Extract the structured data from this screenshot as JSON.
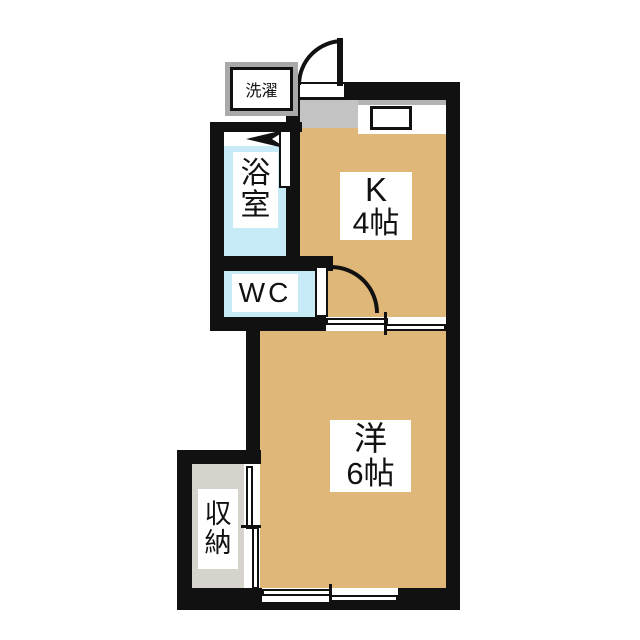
{
  "floorplan": {
    "background": "#ffffff",
    "colors": {
      "wall": "#111111",
      "floor_tan": "#dfb778",
      "wet_cyan": "#c6eaf6",
      "genkan_gray": "#c3c3c3",
      "storage_gray": "#d6d3cc",
      "washer_frame_gray": "#a9a9a9",
      "counter_edge_gray": "#b3b3b3",
      "label_bg": "#ffffff"
    },
    "rooms": {
      "washer": {
        "label": "洗濯"
      },
      "bath": {
        "label_line1": "浴",
        "label_line2": "室"
      },
      "wc": {
        "label": "WC"
      },
      "kitchen": {
        "label_line1": "K",
        "label_line2": "4帖"
      },
      "western_room": {
        "label_line1": "洋",
        "label_line2": "6帖"
      },
      "storage": {
        "label_line1": "収",
        "label_line2": "納"
      }
    }
  }
}
